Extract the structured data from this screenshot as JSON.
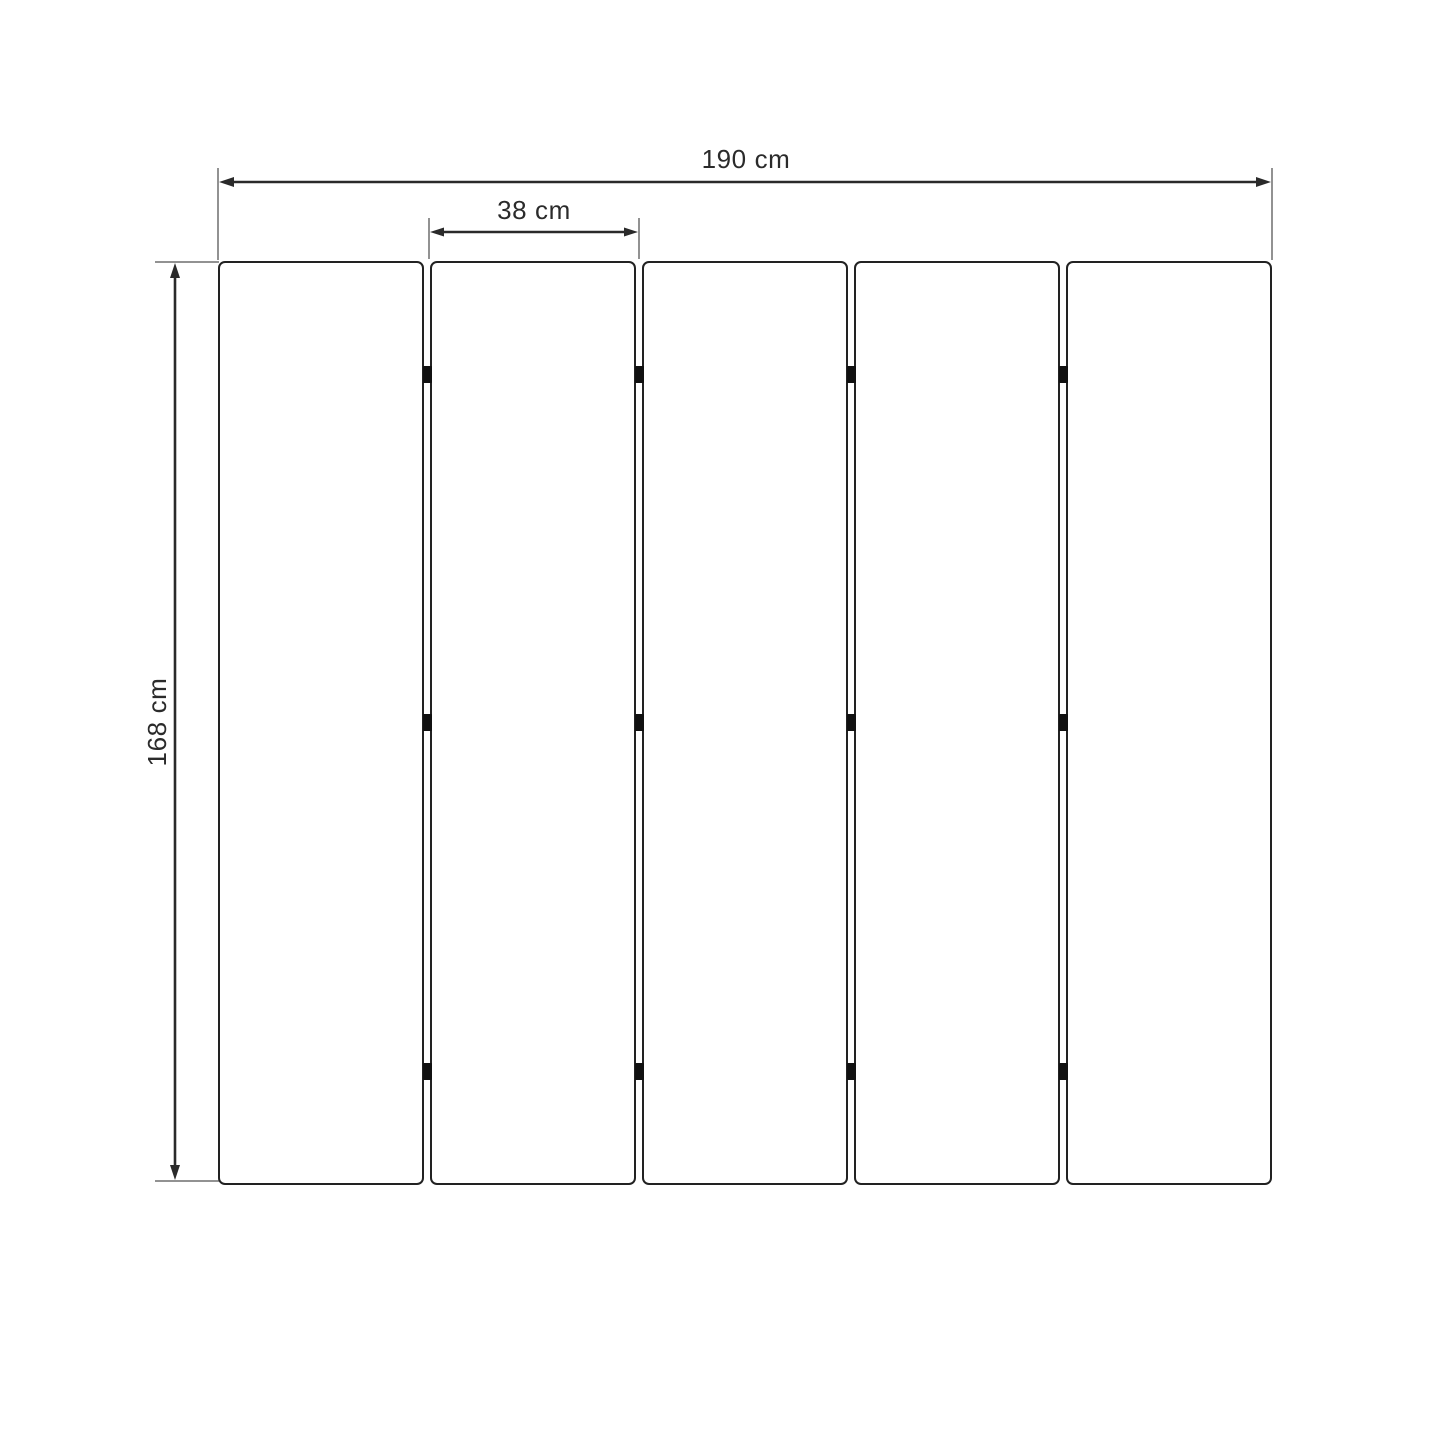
{
  "diagram": {
    "kind": "dimension-diagram",
    "panel_count": 5,
    "hinge_rows": 3,
    "dimensions": {
      "total_width": {
        "label": "190 cm",
        "value": 190,
        "unit": "cm"
      },
      "panel_width": {
        "label": "38 cm",
        "value": 38,
        "unit": "cm"
      },
      "height": {
        "label": "168 cm",
        "value": 168,
        "unit": "cm"
      }
    },
    "colors": {
      "background": "#ffffff",
      "panel_fill": "#ffffff",
      "panel_border": "#222222",
      "hinge": "#111111",
      "dimension_line": "#2a2a2a",
      "extension_line": "#6e6e6e",
      "label_text": "#2b2b2b"
    }
  }
}
